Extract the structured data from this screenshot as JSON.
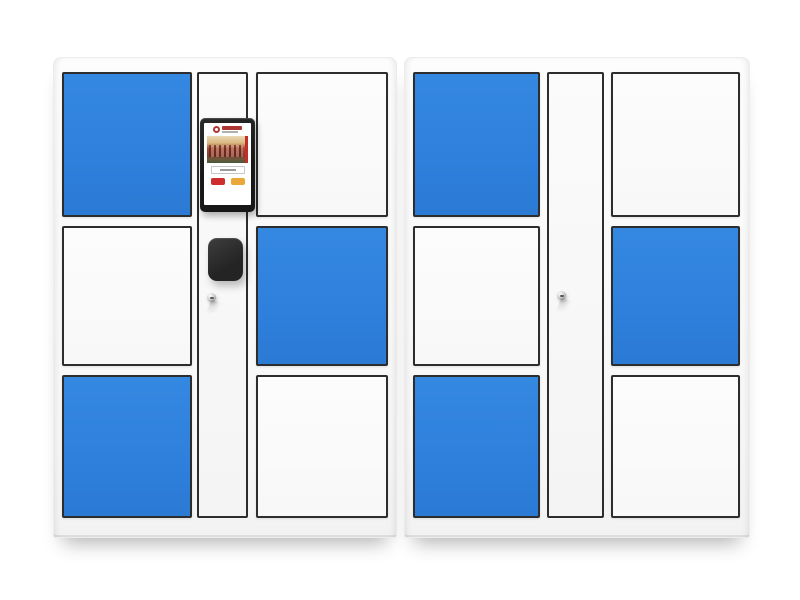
{
  "scene": {
    "type": "product-photo",
    "subject": "two smart parcel locker cabinets with blue and white doors",
    "background_color": "#ffffff",
    "cabinet_count": 2
  },
  "colors": {
    "door_blue": "#2e80dc",
    "door_white": "#fbfbfb",
    "door_border": "#2d2d2d",
    "cabinet_body": "#f7f7f7",
    "screen_bezel": "#171717",
    "scanner": "#242424",
    "screen_logo_red": "#ad3730",
    "screen_banner_red": "#c22f2a",
    "screen_button_red": "#cd2e2c",
    "screen_button_yellow": "#eaa838",
    "keyhole_metal": "#b5b5b5"
  },
  "cabinets": [
    {
      "id": "cabinet-left",
      "columns": {
        "left_doors": [
          {
            "color": "blue"
          },
          {
            "color": "white"
          },
          {
            "color": "blue"
          }
        ],
        "right_doors": [
          {
            "color": "white"
          },
          {
            "color": "blue"
          },
          {
            "color": "white"
          }
        ],
        "center_console": {
          "screen_present": true,
          "screen": {
            "logo": "university-red-seal-with-red-text",
            "photo": "campus-gate-photo",
            "input_box": "tiny-text-field",
            "buttons": [
              "red-button",
              "yellow-button"
            ]
          },
          "scanner_present": true,
          "keyhole_present": true
        }
      }
    },
    {
      "id": "cabinet-right",
      "columns": {
        "left_doors": [
          {
            "color": "blue"
          },
          {
            "color": "white"
          },
          {
            "color": "blue"
          }
        ],
        "right_doors": [
          {
            "color": "white"
          },
          {
            "color": "blue"
          },
          {
            "color": "white"
          }
        ],
        "center_console": {
          "screen_present": false,
          "scanner_present": false,
          "keyhole_present": true
        }
      }
    }
  ]
}
